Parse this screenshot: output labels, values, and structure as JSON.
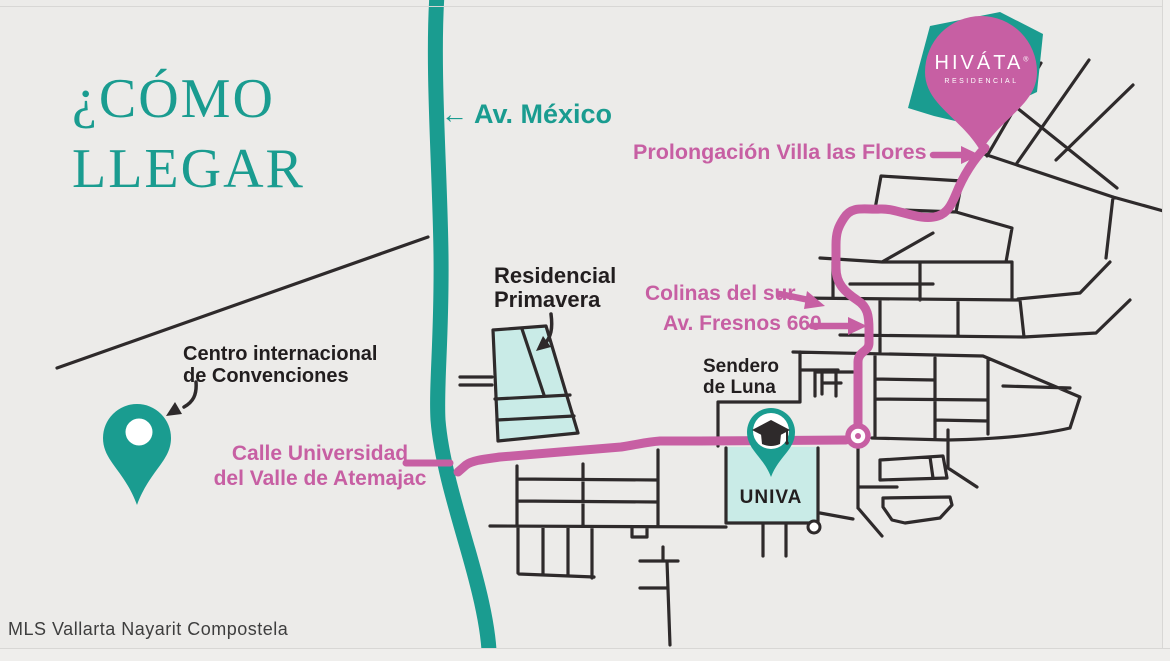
{
  "title": {
    "line1": "¿CÓMO",
    "line2": "LLEGAR"
  },
  "brand_pin": {
    "name": "HIVÁTA",
    "mark": "®",
    "subtitle": "RESIDENCIAL"
  },
  "streets": {
    "av_mexico": {
      "arrow": "←",
      "label": "Av. México"
    },
    "prolongacion_villa_las_flores": "Prolongación Villa las Flores",
    "colinas_del_sur": "Colinas del sur",
    "av_fresnos": "Av. Fresnos 660",
    "calle_universidad_line1": "Calle Universidad",
    "calle_universidad_line2": "del Valle de Atemajac",
    "sendero_line1": "Sendero",
    "sendero_line2": "de Luna"
  },
  "places": {
    "residencial_primavera_line1": "Residencial",
    "residencial_primavera_line2": "Primavera",
    "centro_convenciones_line1": "Centro internacional",
    "centro_convenciones_line2": "de Convenciones",
    "univa": "UNIVA"
  },
  "watermark": "MLS Vallarta Nayarit Compostela",
  "colors": {
    "teal": "#1A9C90",
    "pink": "#C75FA3",
    "light_cyan": "#C9EBE7",
    "road_black": "#2E2A2B",
    "background": "#ECEBE9",
    "text_black": "#221E1F",
    "watermark_gray": "#3E3E3E"
  }
}
